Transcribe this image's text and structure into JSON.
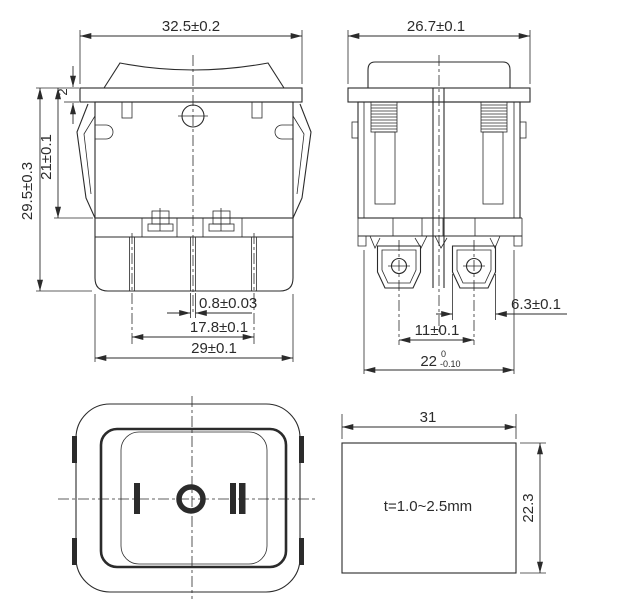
{
  "dwg": {
    "front": {
      "dim_top_width": "32.5±0.2",
      "dim_flange_thickness": "2",
      "dim_upper_height": "21±0.1",
      "dim_overall_height": "29.5±0.3",
      "dim_pin_thickness": "0.8±0.03",
      "dim_pin_span": "17.8±0.1",
      "dim_body_width": "29±0.1"
    },
    "side": {
      "dim_top_width": "26.7±0.1",
      "dim_terminal_width": "6.3±0.1",
      "dim_terminal_pitch": "11±0.1",
      "dim_depth_nominal": "22",
      "dim_depth_tol_upper": "0",
      "dim_depth_tol_lower": "-0.10"
    },
    "top": {
      "marking_left": "I",
      "marking_center": "O",
      "marking_right": "II"
    },
    "cutout": {
      "dim_width": "31",
      "dim_height": "22.3",
      "note_thickness": "t=1.0~2.5mm"
    },
    "colors": {
      "line": "#2b2b2b",
      "background": "#ffffff"
    }
  }
}
